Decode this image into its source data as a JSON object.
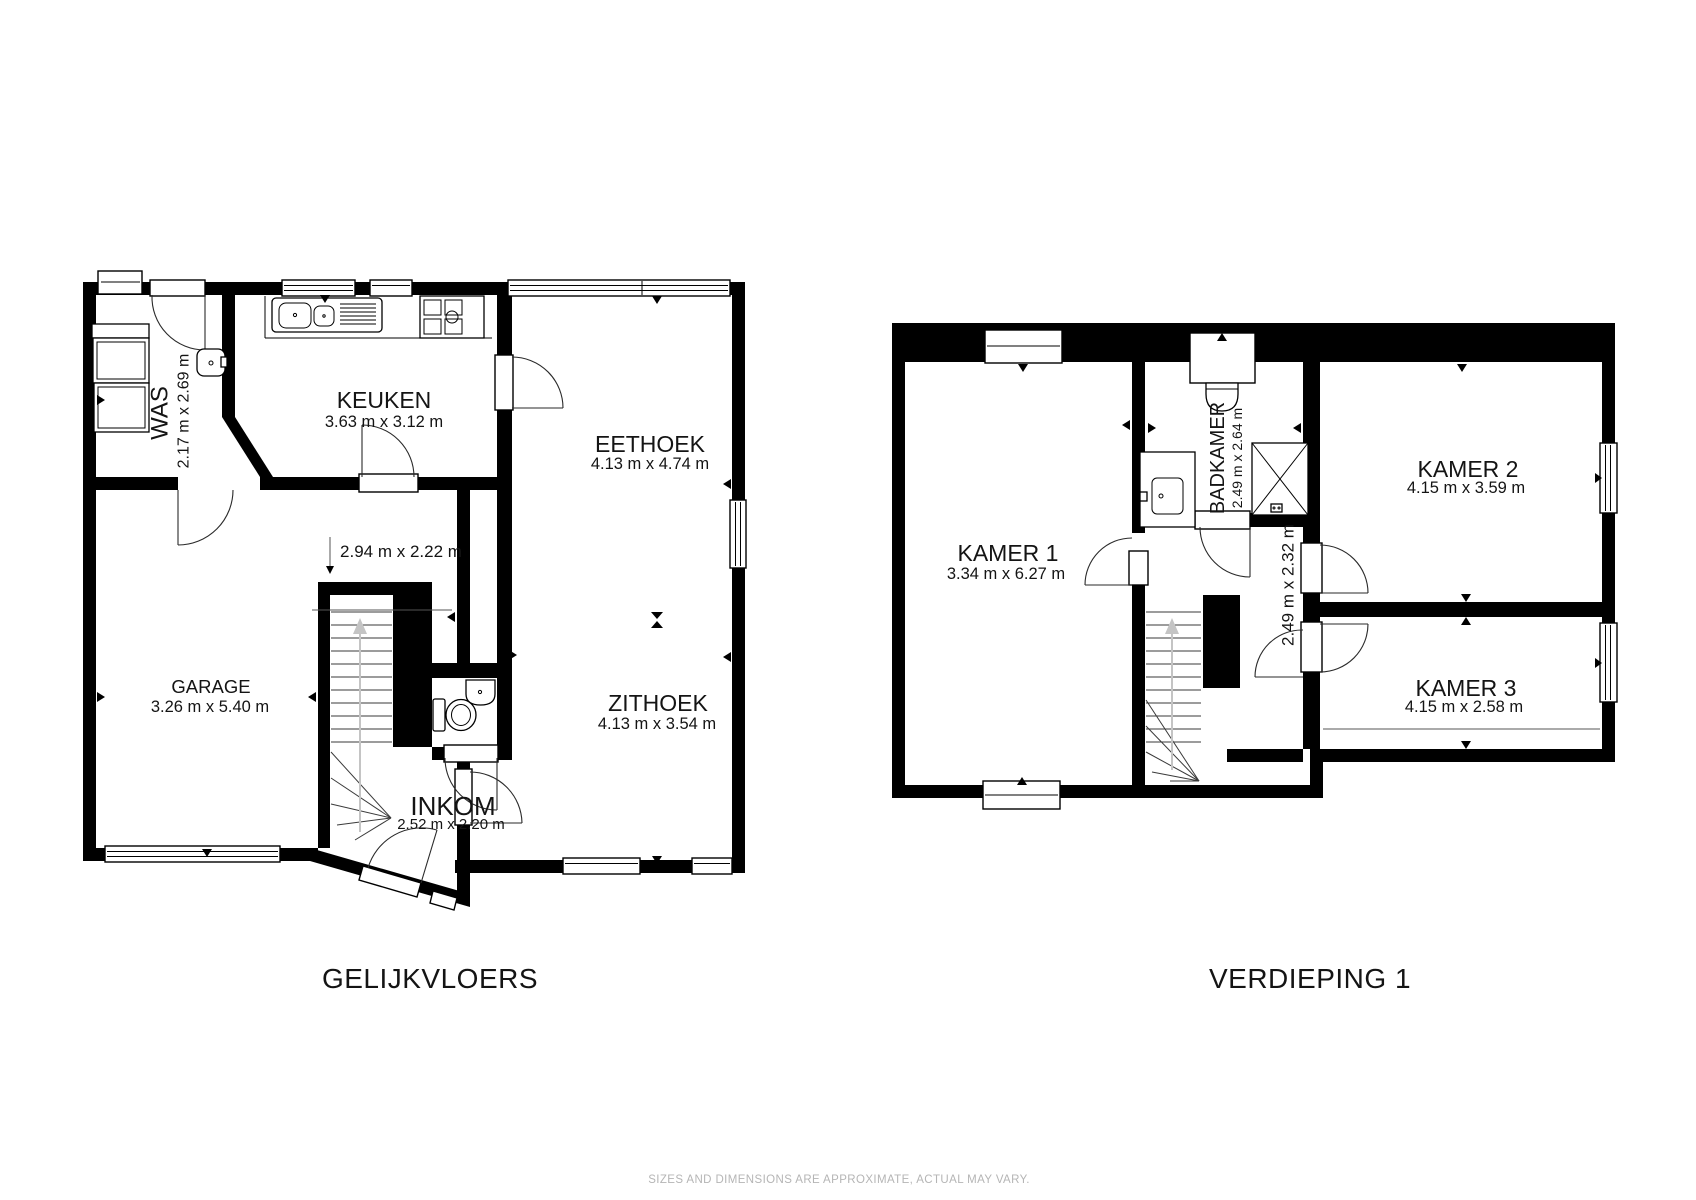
{
  "page": {
    "disclaimer": "SIZES AND DIMENSIONS ARE APPROXIMATE, ACTUAL MAY VARY.",
    "colors": {
      "walls": "#000000",
      "text": "#141414",
      "muted_text": "#b5b5b5",
      "stair_arrow": "#c4c4c4"
    }
  },
  "floors": [
    {
      "title": "GELIJKVLOERS",
      "rooms": [
        {
          "name": "WAS",
          "dims": "2.17 m x 2.69 m"
        },
        {
          "name": "KEUKEN",
          "dims": "3.63 m x 3.12 m"
        },
        {
          "name": "EETHOEK",
          "dims": "4.13 m x 4.74 m"
        },
        {
          "name": "",
          "dims": "2.94 m x 2.22 m"
        },
        {
          "name": "GARAGE",
          "dims": "3.26 m x 5.40 m"
        },
        {
          "name": "ZITHOEK",
          "dims": "4.13 m x 3.54 m"
        },
        {
          "name": "INKOM",
          "dims": "2.52 m x 2.20 m"
        }
      ]
    },
    {
      "title": "VERDIEPING 1",
      "rooms": [
        {
          "name": "KAMER 1",
          "dims": "3.34 m x 6.27 m"
        },
        {
          "name": "BADKAMER",
          "dims": "2.49 m x 2.64 m"
        },
        {
          "name": "",
          "dims": "2.49 m x 2.32 m"
        },
        {
          "name": "KAMER 2",
          "dims": "4.15 m x 3.59 m"
        },
        {
          "name": "KAMER 3",
          "dims": "4.15 m x 2.58 m"
        }
      ]
    }
  ]
}
